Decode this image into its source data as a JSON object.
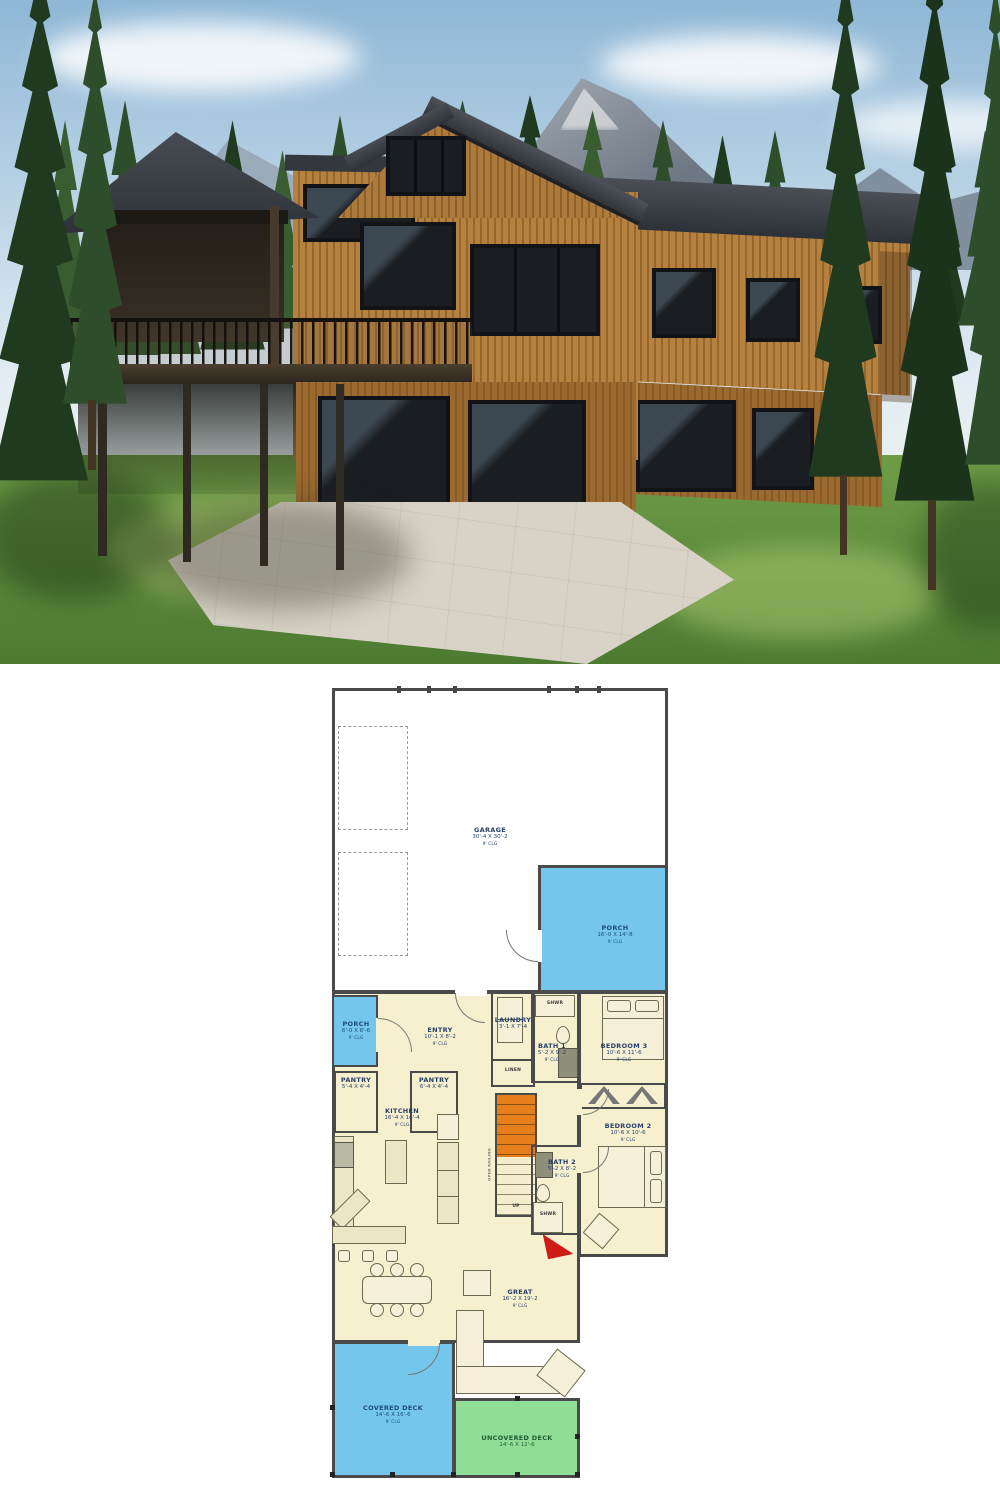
{
  "palette": {
    "wall": "#4a4a4a",
    "plan-cream": "#f6f0cf",
    "porch-blue": "#74c6ec",
    "deck-green": "#90dd98",
    "stair-orange": "#e67e1c",
    "fire-red": "#cf1b15",
    "label-navy": "#27406a",
    "sky-top": "#8fb7d6",
    "sky-bottom": "#e3edf3",
    "mountain": "#87919d",
    "pine-dark": "#1f3a1e",
    "pine-mid": "#2e4d2a",
    "pine-light": "#3a5c31",
    "wood": "#b5813f",
    "wood-dark": "#96662e",
    "glass": "#1a1e23",
    "patio": "#d8d3c6"
  },
  "floor_plan": {
    "rooms": [
      {
        "label": "GARAGE",
        "dims": "30'-4 X 30'-2",
        "ceiling": "9' CLG"
      },
      {
        "label": "PORCH",
        "dims": "16'-0 X 14'-8",
        "ceiling": "9' CLG"
      },
      {
        "label": "PORCH",
        "dims": "6'-0 X 8'-6",
        "ceiling": "9' CLG"
      },
      {
        "label": "ENTRY",
        "dims": "10'-1 X 8'-2",
        "ceiling": "9' CLG"
      },
      {
        "label": "PANTRY",
        "dims": "5'-4 X 4'-4",
        "ceiling": ""
      },
      {
        "label": "PANTRY",
        "dims": "6'-4 X 4'-4",
        "ceiling": ""
      },
      {
        "label": "KITCHEN",
        "dims": "16'-4 X 16'-4",
        "ceiling": "9' CLG"
      },
      {
        "label": "LAUNDRY",
        "dims": "3'-1 X 7'-4",
        "ceiling": ""
      },
      {
        "label": "BATH 1",
        "dims": "5'-2 X 9'-2",
        "ceiling": "9' CLG"
      },
      {
        "label": "BEDROOM 3",
        "dims": "10'-6 X 11'-6",
        "ceiling": "9' CLG"
      },
      {
        "label": "BEDROOM 2",
        "dims": "10'-6 X 10'-6",
        "ceiling": "9' CLG"
      },
      {
        "label": "BATH 2",
        "dims": "5'-2 X 8'-2",
        "ceiling": "9' CLG"
      },
      {
        "label": "GREAT",
        "dims": "16'-2 X 19'-2",
        "ceiling": "9' CLG"
      },
      {
        "label": "COVERED DECK",
        "dims": "14'-6 X 16'-6",
        "ceiling": "9' CLG"
      },
      {
        "label": "UNCOVERED DECK",
        "dims": "14'-6 X 12'-6",
        "ceiling": ""
      }
    ],
    "misc": {
      "linen": "LINEN",
      "shwr1": "SHWR",
      "shwr2": "SHWR",
      "up": "UP",
      "open_railing": "OPEN RAILING"
    }
  }
}
